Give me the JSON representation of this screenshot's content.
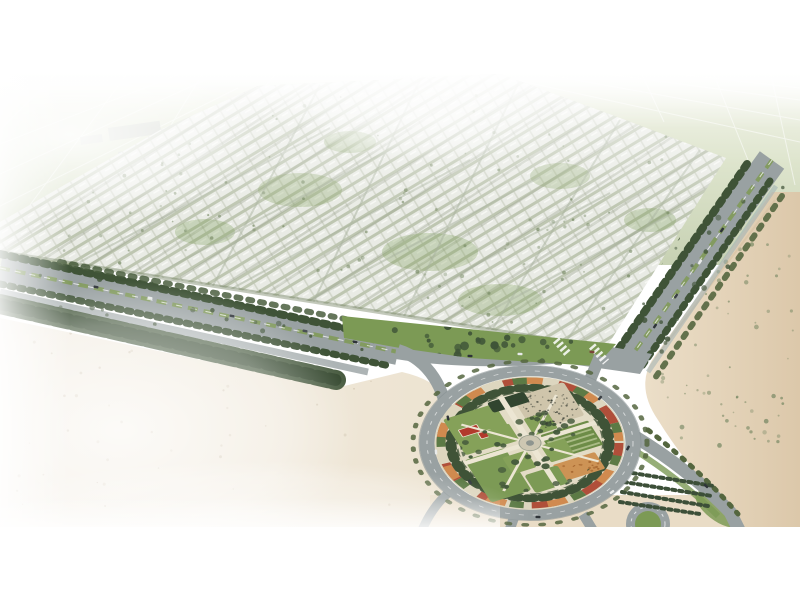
{
  "scene": {
    "title": "Aerial rendering of a desert master-planned residential community",
    "description": "Bird's-eye architectural rendering: a large grid of white low-rise residential blocks with green streets sits in a desert. Tree-lined boulevards border the community on two sides, meeting at a large circular landscaped roundabout park with lawns, gardens, a red-roofed pavilion and a central plaza. Pale farmland fields fade into haze at the horizon; bare sand surrounds the foreground.",
    "elements": [
      "hazy-horizon-fields",
      "distant-industrial-buildings",
      "residential-district",
      "southwest-boulevard",
      "southeast-corridor",
      "frontage-green-strip",
      "circular-roundabout-park",
      "park-ring-road",
      "red-roof-pavilion",
      "event-plaza-crowd",
      "crop-garden",
      "orange-garden",
      "central-fountain-plaza",
      "desert-sand-left",
      "desert-sand-right",
      "secondary-roundabout",
      "tree-nursery-rows",
      "vehicles"
    ]
  },
  "palette": {
    "dev-base": "#e9ebe5",
    "dev-row": "#bec6b1",
    "dev-div": "#d2d6ca",
    "field": "#ccd6b8",
    "field-light": "#e4e9d6",
    "road": "#99a1a2",
    "road-dark": "#868f91",
    "tree": "#3f5337",
    "tree-mid": "#54663f",
    "tree-soft": "#6f835c",
    "grass": "#7c9a55",
    "lawn": "#85a159",
    "median": "#7f9a55",
    "sand-left": "#efe8d9",
    "sand-left-deep": "#e7dbc5",
    "sand-right": "#e9d9c1",
    "sand-right-deep": "#dcc8aa",
    "park-base": "#ddd6bf",
    "path-cream": "#ece6d3",
    "flower-red": "#b04f3a",
    "flower-orange": "#d08a4f",
    "flower-green": "#5c7a45",
    "roof-red": "#b23a2c",
    "plaza": "#cfc5ab",
    "crop": "#6d8c47",
    "crop-light": "#a9bb85",
    "orange-garden": "#cd9355",
    "canal": "#9fb0b4",
    "struct-grey": "#d4d7d0"
  },
  "fields": {
    "grid_lines": [
      [
        0,
        206,
        238,
        88
      ],
      [
        0,
        174,
        205,
        80
      ],
      [
        0,
        144,
        178,
        75
      ],
      [
        60,
        70,
        0,
        130
      ],
      [
        130,
        70,
        30,
        205
      ],
      [
        205,
        70,
        105,
        232
      ],
      [
        280,
        70,
        215,
        140
      ],
      [
        470,
        70,
        800,
        142
      ],
      [
        520,
        70,
        800,
        120
      ],
      [
        575,
        70,
        800,
        100
      ],
      [
        640,
        70,
        800,
        88
      ],
      [
        640,
        70,
        664,
        122
      ],
      [
        712,
        70,
        748,
        160
      ],
      [
        770,
        70,
        795,
        185
      ]
    ],
    "distant_structures": [
      [
        108,
        128,
        52,
        13,
        -8
      ],
      [
        152,
        144,
        62,
        12,
        -8
      ],
      [
        118,
        152,
        34,
        9,
        -8
      ],
      [
        190,
        122,
        26,
        8,
        -8
      ],
      [
        80,
        137,
        22,
        8,
        -8
      ],
      [
        230,
        132,
        30,
        9,
        -8
      ],
      [
        298,
        106,
        36,
        9,
        -6
      ],
      [
        348,
        99,
        24,
        7,
        -6
      ]
    ]
  },
  "scatters": [
    {
      "target": "dev-tree-specks",
      "seed": 7,
      "count": 140,
      "x": 60,
      "y": 92,
      "w": 660,
      "h": 250,
      "rmin": 0.8,
      "rmax": 2,
      "color": "#6f835c",
      "omin": 0.3,
      "omax": 0.65
    },
    {
      "target": "greenstrip-trees",
      "seed": 11,
      "count": 36,
      "x": 348,
      "y": 318,
      "w": 262,
      "h": 44,
      "rmin": 2,
      "rmax": 4.5,
      "color": "#3f5438",
      "omin": 0.7,
      "omax": 1
    },
    {
      "target": "sand-right-shrubs",
      "seed": 13,
      "count": 80,
      "x": 642,
      "y": 238,
      "w": 152,
      "h": 210,
      "rmin": 0.8,
      "rmax": 2.4,
      "color": "#7d8c68",
      "omin": 0.35,
      "omax": 0.8
    },
    {
      "target": "sand-left-specks",
      "seed": 17,
      "count": 46,
      "x": 10,
      "y": 330,
      "w": 380,
      "h": 190,
      "rmin": 0.6,
      "rmax": 1.6,
      "color": "#b9aa90",
      "omin": 0.25,
      "omax": 0.5
    },
    {
      "target": "corridor-extra-trees",
      "seed": 37,
      "count": 55,
      "x": 600,
      "y": 160,
      "w": 200,
      "h": 215,
      "rmin": 1.4,
      "rmax": 3,
      "color": "#42553a",
      "omin": 0.5,
      "omax": 0.9
    },
    {
      "target": "boulevard-extra-trees",
      "seed": 41,
      "count": 70,
      "x": 0,
      "y": 248,
      "w": 402,
      "h": 124,
      "rmin": 1.4,
      "rmax": 3,
      "color": "#42553a",
      "omin": 0.5,
      "omax": 0.9
    },
    {
      "target": "park-lawn-trees",
      "seed": 23,
      "count": 48,
      "x": -70,
      "y": -34,
      "w": 122,
      "h": 104,
      "rmin": 2.2,
      "rmax": 4.2,
      "color": "#43583b",
      "omin": 0.75,
      "omax": 1
    },
    {
      "target": "plaza-crowd-dots",
      "seed": 29,
      "count": 70,
      "x": 12,
      "y": -62,
      "w": 52,
      "h": 48,
      "rmin": 0.5,
      "rmax": 1.3,
      "color": "#3a3f35",
      "omin": 0.5,
      "omax": 0.9
    },
    {
      "target": "orange-garden-dots",
      "seed": 31,
      "count": 16,
      "x": 10,
      "y": 40,
      "w": 42,
      "h": 22,
      "rmin": 0.8,
      "rmax": 1.6,
      "color": "#a96a33",
      "omin": 0.7,
      "omax": 1
    }
  ],
  "vehicles": [
    [
      96,
      287,
      12,
      "#2e3338"
    ],
    [
      150,
      298,
      12,
      "#e8eaea"
    ],
    [
      232,
      316,
      12,
      "#2e3338"
    ],
    [
      305,
      331,
      12,
      "#4a4f55"
    ],
    [
      355,
      342,
      12,
      "#2e3338"
    ],
    [
      470,
      356,
      3,
      "#2e3338"
    ],
    [
      520,
      354,
      3,
      "#e8eaea"
    ],
    [
      722,
      230,
      -55,
      "#2e3338"
    ],
    [
      700,
      262,
      -55,
      "#e8eaea"
    ],
    [
      676,
      296,
      -55,
      "#3a3f44"
    ],
    [
      655,
      326,
      -55,
      "#2e3338"
    ],
    [
      592,
      352,
      8,
      "#7a4438"
    ],
    [
      448,
      418,
      78,
      "#2e3338"
    ],
    [
      470,
      482,
      55,
      "#3a3f44"
    ],
    [
      538,
      517,
      2,
      "#2e3338"
    ],
    [
      612,
      492,
      -35,
      "#e8eaea"
    ],
    [
      628,
      448,
      -62,
      "#2e3338"
    ],
    [
      600,
      398,
      -48,
      "#3a3f44"
    ],
    [
      706,
      486,
      42,
      "#2e3338"
    ],
    [
      436,
      452,
      85,
      "#e8eaea"
    ]
  ]
}
